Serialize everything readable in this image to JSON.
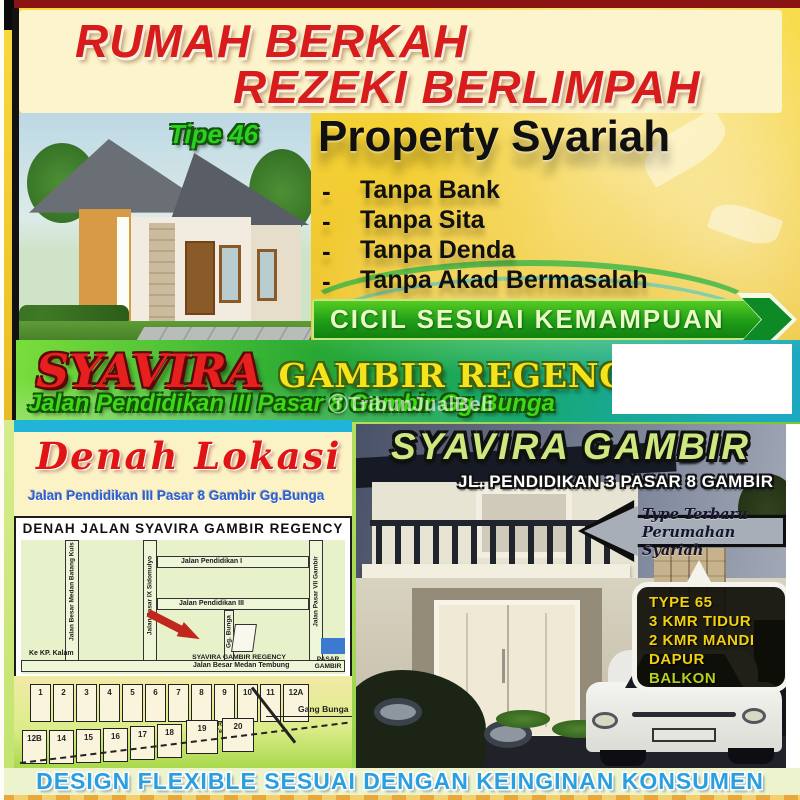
{
  "header": {
    "line1": "RUMAH BERKAH",
    "line2": "REZEKI BERLIMPAH"
  },
  "top_house": {
    "type_label": "Tipe 46"
  },
  "promo": {
    "title": "Property Syariah",
    "dash": "-",
    "bullets": [
      "Tanpa Bank",
      "Tanpa Sita",
      "Tanpa Denda",
      "Tanpa Akad Bermasalah"
    ],
    "banner": "CICIL SESUAI KEMAMPUAN"
  },
  "brand": {
    "name": "SYAVIRA",
    "suffix": "GAMBIR REGENCY",
    "address": "Jalan Pendidikan III Pasar 8 Gambir Gg.Bunga",
    "watermark": "ⓉTribunJualBeli"
  },
  "map_panel": {
    "heading": "Denah Lokasi",
    "subheading": "Jalan Pendidikan III Pasar 8 Gambir Gg.Bunga",
    "map_title": "DENAH JALAN SYAVIRA GAMBIR REGENCY",
    "roads": {
      "pendidikan1": "Jalan  Pendidikan I",
      "pendidikan3": "Jalan  Pendidikan III",
      "batang_kuis": "Jalan Besar Medan Batang Kuis",
      "pasar9": "Jalan Pasar IX Sidomulyo",
      "gg_bunga": "Gg. Bunga",
      "pasar7": "Jalan Pasar VII Gambir",
      "medan_tembung": "Jalan  Besar Medan Tembung",
      "ke_kp_kalam": "Ke KP. Kalam"
    },
    "marker_label": "SYAVIRA GAMBIR REGENCY",
    "landmark_label": "PASAR GAMBIR",
    "site_plan": {
      "row1": [
        "1",
        "2",
        "3",
        "4",
        "5",
        "6",
        "7",
        "8",
        "9",
        "10",
        "11",
        "12A"
      ],
      "row2": [
        "12B",
        "14",
        "15",
        "16",
        "17",
        "18",
        "19",
        "20"
      ],
      "gang_label": "Gang Bunga",
      "open_space_label": "Ruang Terbuka"
    }
  },
  "photo_panel": {
    "title": "SYAVIRA GAMBIR",
    "subtitle": "JL. PENDIDIKAN 3 PASAR 8 GAMBIR",
    "arrow_note": {
      "line1": "Type Terbaru",
      "line2": "Perumahan Syariah"
    },
    "specs": [
      "TYPE 65",
      "3 KMR TIDUR",
      "2 KMR MANDI",
      "DAPUR",
      "BALKON"
    ]
  },
  "footer": {
    "text": "DESIGN FLEXIBLE SESUAI DENGAN KEINGINAN KONSUMEN"
  },
  "colors": {
    "accent_red": "#d81c1c",
    "banner_green": "#1f9d18",
    "brand_yellow": "#f4e41c",
    "title_green": "#cde87e",
    "spec_yellow": "#f0d010",
    "footer_blue": "#2a9fe0"
  }
}
